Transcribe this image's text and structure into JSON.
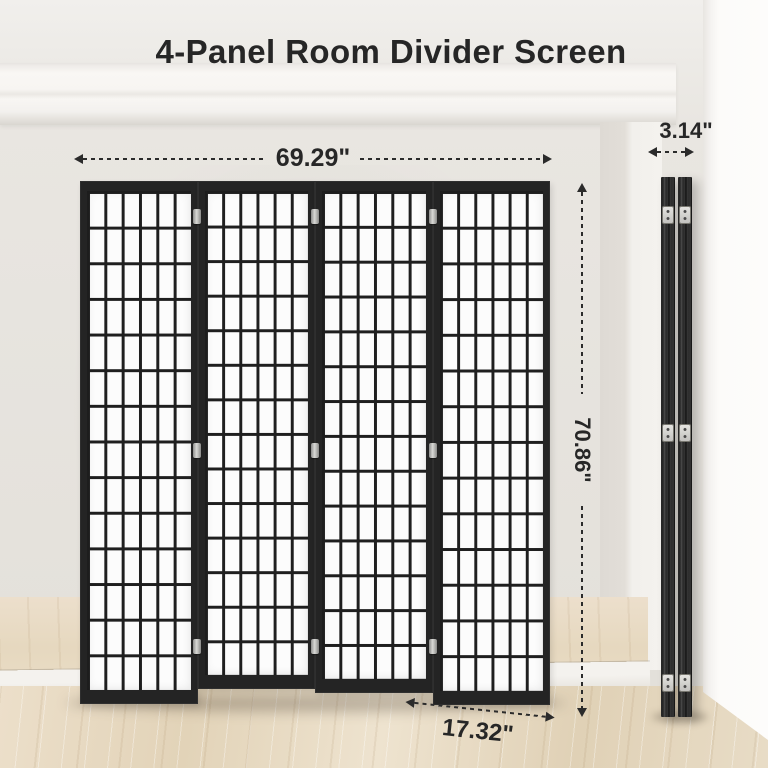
{
  "title": "4-Panel Room Divider Screen",
  "dimensions": {
    "width": "69.29\"",
    "depth_folded": "3.14\"",
    "height": "70.86\"",
    "panel_width": "17.32\""
  },
  "screen": {
    "panel_count": 4,
    "grid_columns_per_panel": 6,
    "grid_rows_per_panel": 14,
    "hinges_per_junction": 3
  },
  "colors": {
    "frame_black": "#242424",
    "shoji_paper": "#fcfcfc",
    "wall": "#e7e4df",
    "molding_white": "#f8f6f3",
    "pillar_white": "#fcfbf9",
    "wood_floor": "#e6d8c1",
    "annotation_text": "#2b2b2b"
  }
}
